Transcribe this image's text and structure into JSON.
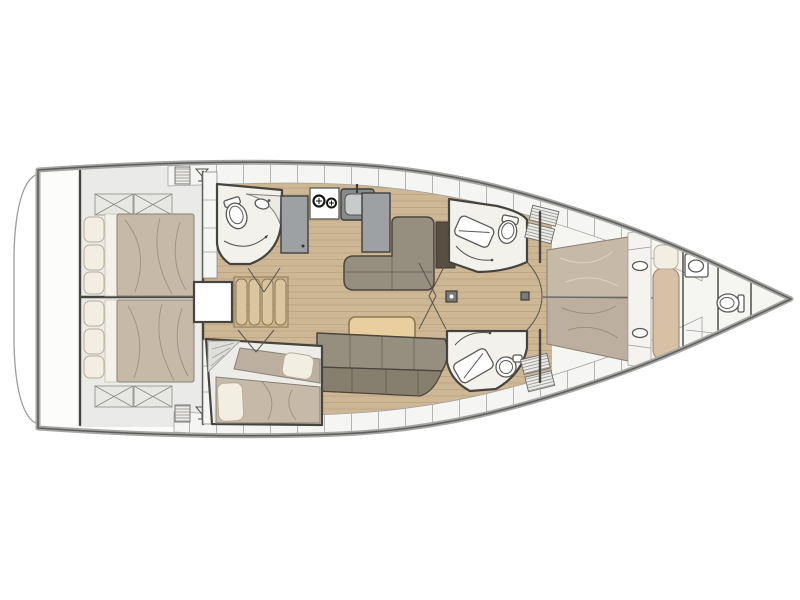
{
  "page": {
    "background": "#ffffff"
  },
  "diagram": {
    "type": "yacht-interior-floor-plan",
    "orientation": "bow-right",
    "colors": {
      "hullOuter": "#a6a6a4",
      "hullInner": "#5f5f5d",
      "deck": "#eaeae8",
      "cells": "#f5f5f3",
      "tick": "#b4b4b0",
      "wood": "#cdb795",
      "woodLine": "#ab9269",
      "room": "#f2f1ec",
      "wall": "#45443f",
      "mattress": "#c7b9a7",
      "mattressAlt": "#bdafa0",
      "pillow": "#f3eee2",
      "pillowLine": "#b8ad99",
      "sheet": "#f4f1e8",
      "sofa": "#968f80",
      "sofaDark": "#867f6e",
      "sofaLine": "#4b453b",
      "table": "#e9cf9f",
      "tableLine": "#8f7950",
      "counter": "#9ea1a3",
      "appliance": "#3f3f3d",
      "steps": "#d9c59e",
      "stepsLine": "#8c7752",
      "panel": "#584e42",
      "bench": "#d6c1a5",
      "benchLine": "#a3906f",
      "fwdFloor": "#f5f5f2",
      "fixLine": "#5b5955"
    },
    "regions": [
      {
        "id": "swim-platform",
        "label": "swim platform"
      },
      {
        "id": "aft-cabin-port",
        "label": "aft double cabin (port)"
      },
      {
        "id": "aft-cabin-starboard",
        "label": "aft double cabin (starboard)"
      },
      {
        "id": "aft-head",
        "label": "aft head with toilet and vanity"
      },
      {
        "id": "galley",
        "label": "galley with fridge, stove and sink"
      },
      {
        "id": "salon",
        "label": "salon with settees and table"
      },
      {
        "id": "companionway",
        "label": "companionway steps"
      },
      {
        "id": "single-berth-cabin",
        "label": "single berth cabin"
      },
      {
        "id": "forward-head-port",
        "label": "forward head with shower (port)"
      },
      {
        "id": "forward-head-starboard",
        "label": "forward head with shower (starboard)"
      },
      {
        "id": "owner-cabin",
        "label": "forward owner cabin with double bed"
      },
      {
        "id": "bow-head",
        "label": "bow crew head with sink and toilet"
      }
    ]
  }
}
